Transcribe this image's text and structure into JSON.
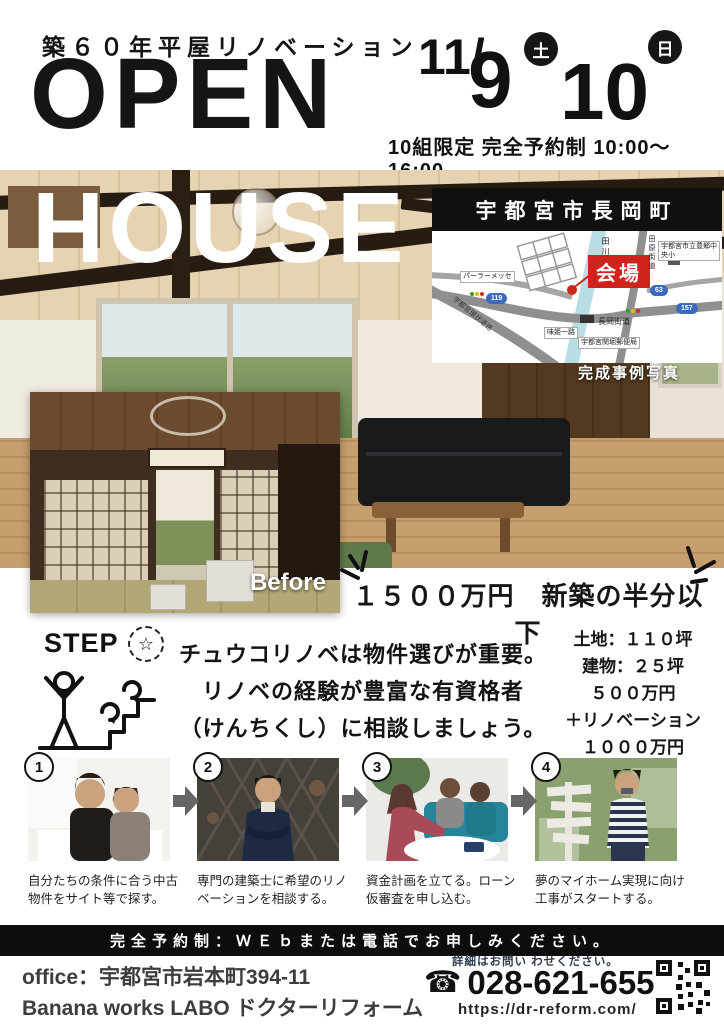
{
  "header": {
    "subtitle": "築６０年平屋リノベーション",
    "title_line1": "OPEN",
    "title_line2": "HOUSE",
    "date_month": "11/",
    "day1": "9",
    "day1_dow": "土",
    "day2": "10",
    "day2_dow": "日",
    "conditions": "10組限定 完全予約制 10:00～16:00"
  },
  "map": {
    "title": "宇都宮市長岡町",
    "venue": "会場",
    "river": "田川",
    "labels": [
      "パーラーメッセ",
      "長岡街道",
      "味姫一路",
      "宇都宮環状道路",
      "田原街道",
      "宇都宮市立豊郷中央小",
      "宇都宮関堀郵便局"
    ],
    "badges": [
      "119",
      "157",
      "63"
    ]
  },
  "photo": {
    "after_caption": "完成事例写真",
    "before_label": "Before"
  },
  "price": {
    "headline": "１５００万円　新築の半分以下",
    "details": [
      "土地：１１０坪",
      "建物：２５坪",
      "５００万円",
      "＋リノベーション",
      "１０００万円"
    ]
  },
  "step": {
    "label": "STEP",
    "star": "☆",
    "advice": [
      "チュウコリノベは物件選びが重要。",
      "リノベの経験が豊富な有資格者",
      "（けんちくし）に相談しましょう。"
    ],
    "items": [
      {
        "num": "1",
        "caption": "自分たちの条件に合う中古物件をサイト等で探す。"
      },
      {
        "num": "2",
        "caption": "専門の建築士に希望のリノベーションを相談する。"
      },
      {
        "num": "3",
        "caption": "資金計画を立てる。ローン仮審査を申し込む。"
      },
      {
        "num": "4",
        "caption": "夢のマイホーム実現に向け工事がスタートする。"
      }
    ]
  },
  "footer": {
    "bar": "完全予約制：ＷＥｂまたは電話でお申しみください。",
    "office_line1": "office：宇都宮市岩本町394-11",
    "office_line2": "Banana works LABO ドクターリフォーム",
    "contact_note": "詳細はお問い わせください。",
    "phone_icon": "☎",
    "phone": "028-621-6551",
    "url": "https://dr-reform.com/"
  },
  "colors": {
    "accent_red": "#cf241b",
    "bar_black": "#0d0d0d",
    "river_blue": "#b8dde2",
    "road_gray": "#909090",
    "badge_blue": "#3a6bbf",
    "note_navy": "#2e3c52"
  }
}
